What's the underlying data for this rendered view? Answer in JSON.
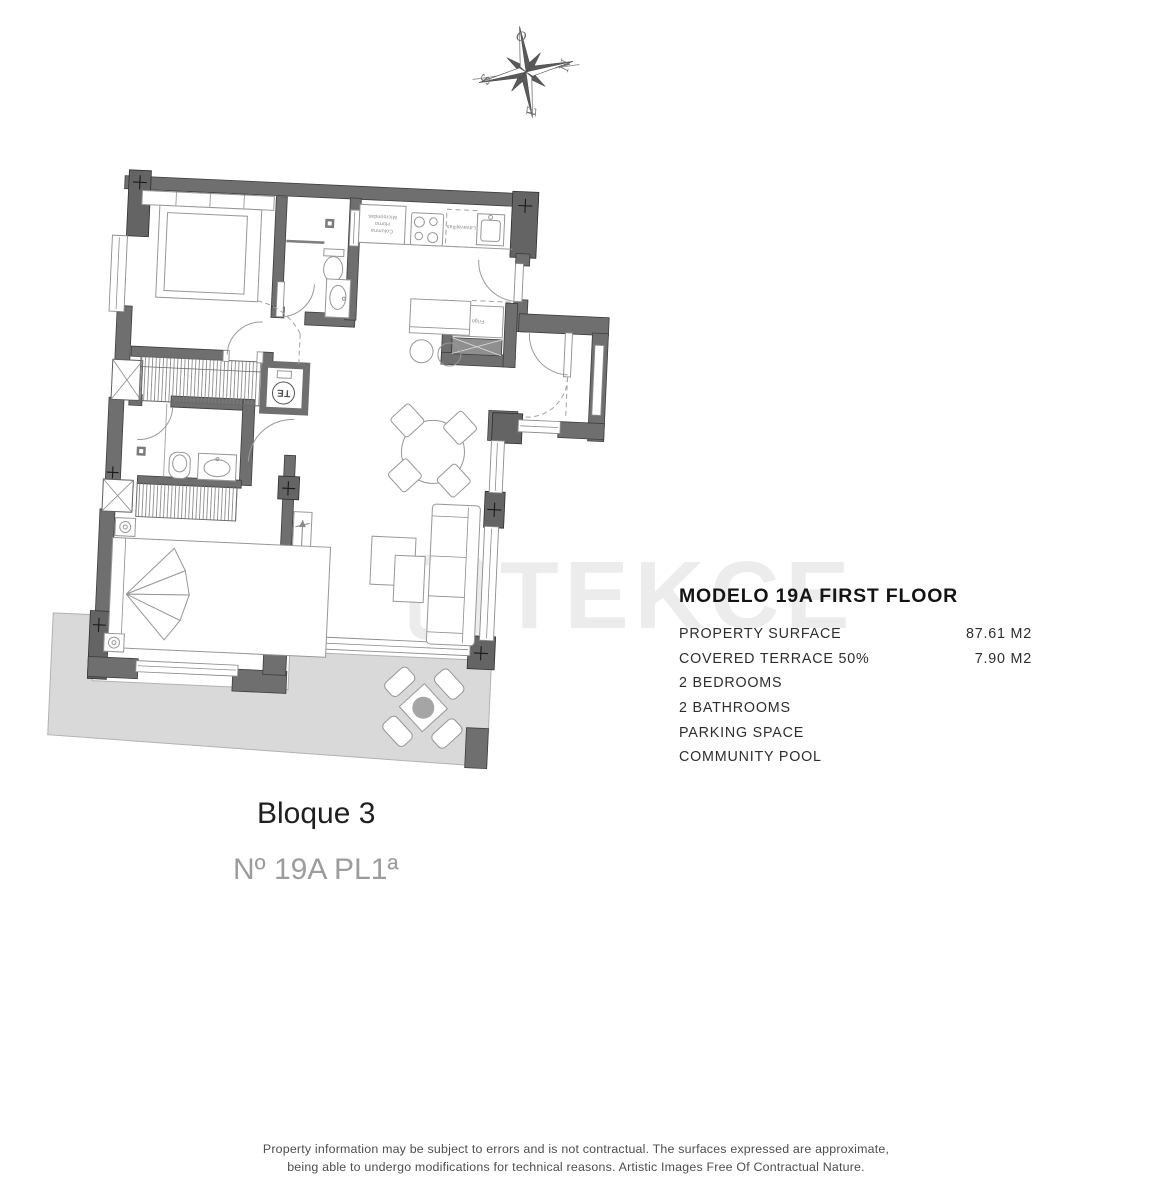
{
  "compass": {
    "west": "O",
    "north": "N",
    "south": "S",
    "east": "E"
  },
  "watermark": {
    "text": "TEKCE"
  },
  "plan_labels": {
    "water_heater": "TE",
    "fridge": "Frigo",
    "dishwasher": "Lavavajillas",
    "column": "Columna",
    "oven": "Horno",
    "microwave": "Microondas"
  },
  "info_panel": {
    "title": "MODELO 19A FIRST FLOOR",
    "rows": [
      {
        "label": "PROPERTY SURFACE",
        "value": "87.61 M2"
      },
      {
        "label": "COVERED TERRACE  50%",
        "value": "7.90 M2"
      },
      {
        "label": "2 BEDROOMS",
        "value": ""
      },
      {
        "label": "2 BATHROOMS",
        "value": ""
      },
      {
        "label": "PARKING SPACE",
        "value": ""
      },
      {
        "label": "COMMUNITY POOL",
        "value": ""
      }
    ]
  },
  "captions": {
    "block": "Bloque 3",
    "unit": "Nº 19A PL1ª"
  },
  "disclaimer": {
    "line1": "Property information may be subject to errors and is not contractual. The surfaces expressed are approximate,",
    "line2": "being able to undergo modifications for technical reasons. Artistic Images Free Of Contractual Nature."
  }
}
